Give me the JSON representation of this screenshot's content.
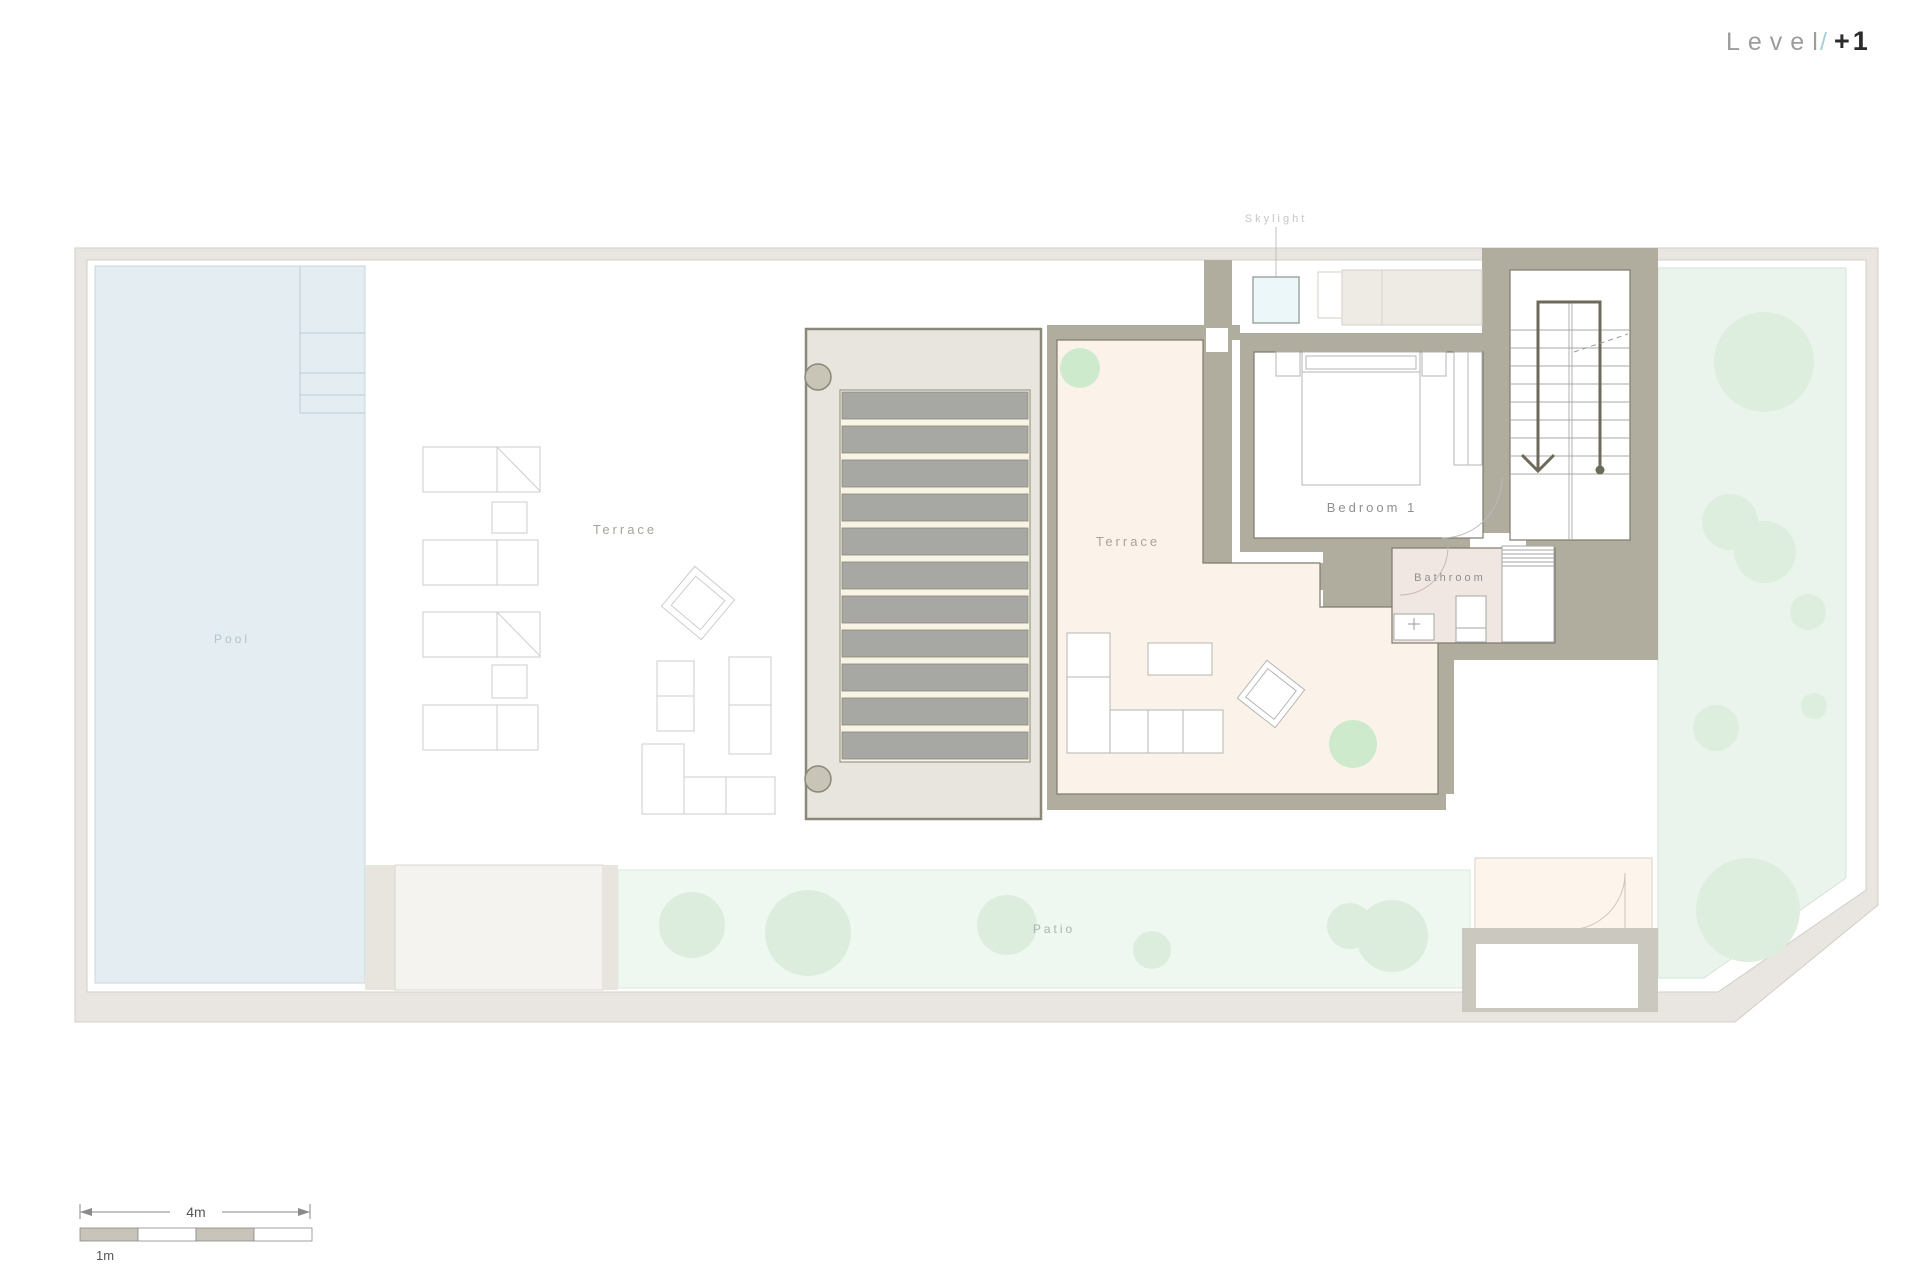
{
  "title": {
    "level": "Level",
    "slash": "/",
    "number": "+1"
  },
  "rooms": {
    "skylight": "Skylight",
    "pool": "Pool",
    "outdoor_terrace": "Terrace",
    "indoor_terrace": "Terrace",
    "bedroom": "Bedroom 1",
    "bathroom": "Bathroom",
    "patio": "Patio"
  },
  "scale_bar": {
    "overall": "4m",
    "segment": "1m"
  },
  "colors": {
    "border_band": "#e9e6e1",
    "wall": "#b1ad9e",
    "pool": "#e3edf2",
    "garden": "#eaf4ec",
    "garden_blob": "#ddeede",
    "patio": "#eef7f0",
    "patio_blob": "#dcedde",
    "terrace_floor": "#fbf3ea",
    "bathroom_floor": "#f0e7e2",
    "pergola_bg": "#e7e5de",
    "slat": "#a7a8a4",
    "slat_gap": "#f7f4e5",
    "post": "#c9c5b6",
    "skylight": "#ecf7f9",
    "plant": "#cdeacd",
    "planter": "#edebe4",
    "entry_floor": "#fdf4ec",
    "slash_accent": "#a9ced8"
  }
}
